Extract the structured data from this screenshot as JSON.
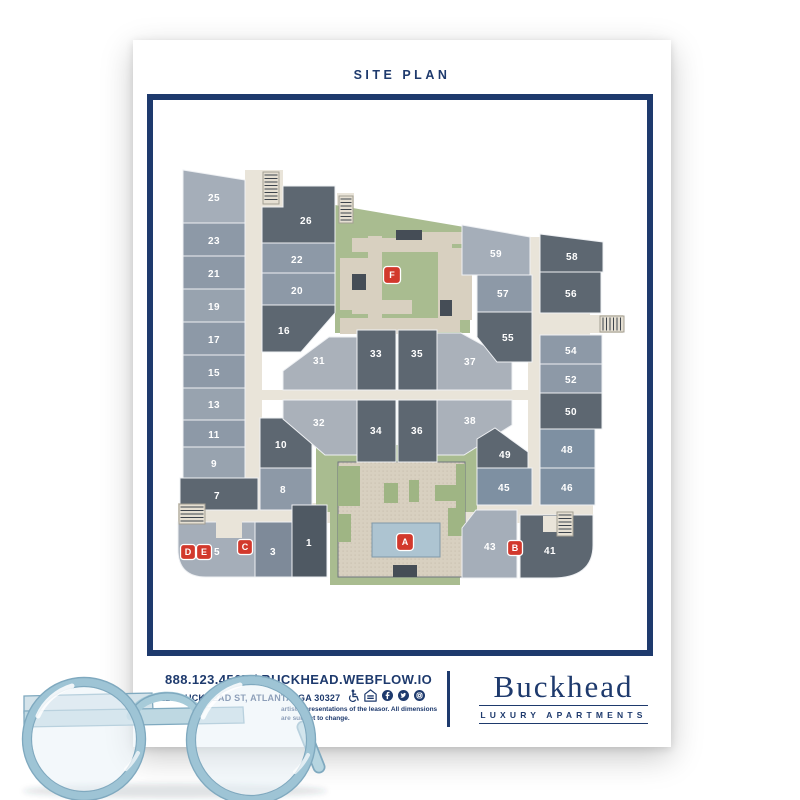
{
  "header": {
    "title": "SITE PLAN"
  },
  "footer": {
    "phone_web": "888.123.4567 / BUCKHEAD.WEBFLOW.IO",
    "address": "123 BUCKHEAD ST, ATLANTA, GA 30327",
    "disclaimer_line1": "artist representations of the leasor. All dimensions",
    "disclaimer_line2": "are subject to change.",
    "logo_name": "Buckhead",
    "logo_tagline": "LUXURY APARTMENTS",
    "icons": [
      "accessibility-icon",
      "equal-housing-icon",
      "facebook-icon",
      "twitter-icon",
      "instagram-icon"
    ]
  },
  "colors": {
    "navy": "#1e3a6d",
    "red": "#d2382c",
    "dark": "#5d6771",
    "dark1": "#4f5963",
    "med": "#8d99a7",
    "med2": "#7e8a99",
    "medblue": "#7e90a2",
    "light": "#a5aeb9",
    "light2": "#98a3af",
    "light3": "#aab1ba",
    "green": "#a9bc90",
    "green2": "#9fb584",
    "tan": "#d8d0c0",
    "road": "#e9e4d9",
    "pool": "#adc4d1",
    "poolStroke": "#7f99a9",
    "darkSq": "#454d56",
    "gap": "#eef0f3",
    "stair": "#e5dfd2",
    "stairStroke": "#a49f93",
    "rung": "#3d444c",
    "plazaStroke": "#6e767e"
  },
  "map": {
    "roads": [
      [
        245,
        170,
        17,
        358
      ],
      [
        245,
        390,
        293,
        10
      ],
      [
        528,
        237,
        12,
        286
      ],
      [
        178,
        503,
        415,
        20
      ],
      [
        262,
        170,
        21,
        37
      ],
      [
        337,
        193,
        17,
        30
      ],
      [
        538,
        313,
        52,
        22
      ],
      [
        590,
        315,
        33,
        18
      ],
      [
        540,
        505,
        40,
        30
      ]
    ],
    "greens": [
      [
        [
          335,
          205
        ],
        [
          470,
          228
        ],
        [
          470,
          333
        ],
        [
          335,
          333
        ]
      ],
      [
        [
          316,
          445
        ],
        [
          477,
          445
        ],
        [
          477,
          512
        ],
        [
          460,
          512
        ],
        [
          460,
          585
        ],
        [
          330,
          585
        ],
        [
          330,
          512
        ],
        [
          316,
          512
        ]
      ]
    ],
    "plaza": [
      [
        338,
        462
      ],
      [
        465,
        462
      ],
      [
        465,
        577
      ],
      [
        338,
        577
      ]
    ],
    "court_tan": [
      [
        352,
        238,
        92,
        14
      ],
      [
        368,
        236,
        14,
        96
      ],
      [
        340,
        258,
        38,
        52
      ],
      [
        340,
        318,
        84,
        16
      ],
      [
        438,
        238,
        14,
        92
      ],
      [
        414,
        232,
        58,
        12
      ],
      [
        452,
        248,
        20,
        72
      ],
      [
        404,
        318,
        56,
        14
      ],
      [
        352,
        300,
        60,
        14
      ]
    ],
    "court_dark": [
      [
        352,
        274,
        14,
        16
      ],
      [
        396,
        230,
        26,
        10
      ],
      [
        440,
        300,
        12,
        16
      ]
    ],
    "patches": [
      [
        338,
        466,
        22,
        40
      ],
      [
        384,
        483,
        14,
        20
      ],
      [
        409,
        480,
        10,
        22
      ],
      [
        435,
        485,
        26,
        16
      ],
      [
        338,
        514,
        13,
        28
      ],
      [
        448,
        508,
        17,
        28
      ],
      [
        456,
        464,
        9,
        44
      ]
    ],
    "pool": [
      372,
      523,
      68,
      34
    ],
    "pool_step": [
      393,
      565,
      24,
      12
    ],
    "units": [
      {
        "n": "25",
        "f": "light",
        "p": [
          [
            183,
            170
          ],
          [
            245,
            180
          ],
          [
            245,
            223
          ],
          [
            183,
            223
          ]
        ],
        "lx": 214,
        "ly": 201
      },
      {
        "n": "23",
        "f": "med",
        "p": [
          [
            183,
            223
          ],
          [
            245,
            223
          ],
          [
            245,
            256
          ],
          [
            183,
            256
          ]
        ],
        "lx": 214,
        "ly": 244
      },
      {
        "n": "21",
        "f": "med",
        "p": [
          [
            183,
            256
          ],
          [
            245,
            256
          ],
          [
            245,
            289
          ],
          [
            183,
            289
          ]
        ],
        "lx": 214,
        "ly": 277
      },
      {
        "n": "19",
        "f": "light2",
        "p": [
          [
            183,
            289
          ],
          [
            245,
            289
          ],
          [
            245,
            322
          ],
          [
            183,
            322
          ]
        ],
        "lx": 214,
        "ly": 310
      },
      {
        "n": "17",
        "f": "med",
        "p": [
          [
            183,
            322
          ],
          [
            245,
            322
          ],
          [
            245,
            355
          ],
          [
            183,
            355
          ]
        ],
        "lx": 214,
        "ly": 343
      },
      {
        "n": "15",
        "f": "med",
        "p": [
          [
            183,
            355
          ],
          [
            245,
            355
          ],
          [
            245,
            388
          ],
          [
            183,
            388
          ]
        ],
        "lx": 214,
        "ly": 376
      },
      {
        "n": "13",
        "f": "light2",
        "p": [
          [
            183,
            388
          ],
          [
            245,
            388
          ],
          [
            245,
            420
          ],
          [
            183,
            420
          ]
        ],
        "lx": 214,
        "ly": 408
      },
      {
        "n": "11",
        "f": "med",
        "p": [
          [
            183,
            420
          ],
          [
            245,
            420
          ],
          [
            245,
            447
          ],
          [
            183,
            447
          ]
        ],
        "lx": 214,
        "ly": 438
      },
      {
        "n": "9",
        "f": "light2",
        "p": [
          [
            183,
            447
          ],
          [
            245,
            447
          ],
          [
            245,
            478
          ],
          [
            183,
            478
          ]
        ],
        "lx": 214,
        "ly": 467
      },
      {
        "n": "7",
        "f": "dark",
        "p": [
          [
            180,
            478
          ],
          [
            258,
            478
          ],
          [
            258,
            510
          ],
          [
            180,
            510
          ]
        ],
        "lx": 217,
        "ly": 499
      },
      {
        "n": "26",
        "f": "dark",
        "p": [
          [
            283,
            186
          ],
          [
            335,
            186
          ],
          [
            335,
            243
          ],
          [
            262,
            243
          ],
          [
            262,
            207
          ],
          [
            283,
            207
          ]
        ],
        "lx": 306,
        "ly": 224
      },
      {
        "n": "22",
        "f": "med",
        "p": [
          [
            262,
            243
          ],
          [
            335,
            243
          ],
          [
            335,
            273
          ],
          [
            262,
            273
          ]
        ],
        "lx": 297,
        "ly": 263
      },
      {
        "n": "20",
        "f": "med",
        "p": [
          [
            262,
            273
          ],
          [
            335,
            273
          ],
          [
            335,
            305
          ],
          [
            262,
            305
          ]
        ],
        "lx": 297,
        "ly": 294
      },
      {
        "n": "16",
        "f": "dark",
        "p": [
          [
            262,
            305
          ],
          [
            335,
            305
          ],
          [
            335,
            313
          ],
          [
            301,
            352
          ],
          [
            262,
            352
          ]
        ],
        "lx": 284,
        "ly": 334
      },
      {
        "n": "10",
        "f": "dark",
        "p": [
          [
            260,
            418
          ],
          [
            287,
            418
          ],
          [
            312,
            444
          ],
          [
            312,
            468
          ],
          [
            260,
            468
          ]
        ],
        "lx": 281,
        "ly": 448
      },
      {
        "n": "8",
        "f": "med",
        "p": [
          [
            260,
            468
          ],
          [
            312,
            468
          ],
          [
            312,
            510
          ],
          [
            260,
            510
          ]
        ],
        "lx": 283,
        "ly": 493
      },
      {
        "n": "1",
        "f": "dark1",
        "p": [
          [
            292,
            505
          ],
          [
            327,
            505
          ],
          [
            327,
            577
          ],
          [
            292,
            577
          ]
        ],
        "lx": 309,
        "ly": 546
      },
      {
        "n": "3",
        "f": "med2",
        "p": [
          [
            255,
            522
          ],
          [
            292,
            522
          ],
          [
            292,
            577
          ],
          [
            255,
            577
          ]
        ],
        "lx": 273,
        "ly": 555
      },
      {
        "n": "5",
        "f": "light",
        "path": "M178,522 L255,522 L255,577 L206,577 Q178,577 178,549 Z",
        "lx": 217,
        "ly": 555
      },
      {
        "n": "31",
        "f": "light3",
        "p": [
          [
            357,
            337
          ],
          [
            357,
            390
          ],
          [
            283,
            390
          ],
          [
            283,
            371
          ],
          [
            329,
            337
          ]
        ],
        "lx": 319,
        "ly": 364
      },
      {
        "n": "33",
        "f": "dark",
        "p": [
          [
            357,
            330
          ],
          [
            396,
            330
          ],
          [
            396,
            390
          ],
          [
            357,
            390
          ]
        ],
        "lx": 376,
        "ly": 357
      },
      {
        "n": "35",
        "f": "dark",
        "p": [
          [
            398,
            330
          ],
          [
            437,
            330
          ],
          [
            437,
            390
          ],
          [
            398,
            390
          ]
        ],
        "lx": 417,
        "ly": 357
      },
      {
        "n": "37",
        "f": "light3",
        "p": [
          [
            437,
            333
          ],
          [
            461,
            333
          ],
          [
            512,
            361
          ],
          [
            512,
            390
          ],
          [
            437,
            390
          ]
        ],
        "lx": 470,
        "ly": 365
      },
      {
        "n": "55",
        "f": "dark",
        "p": [
          [
            477,
            312
          ],
          [
            532,
            312
          ],
          [
            532,
            362
          ],
          [
            497,
            362
          ],
          [
            477,
            337
          ]
        ],
        "lx": 508,
        "ly": 341
      },
      {
        "n": "57",
        "f": "med",
        "p": [
          [
            477,
            275
          ],
          [
            532,
            275
          ],
          [
            532,
            312
          ],
          [
            477,
            312
          ]
        ],
        "lx": 503,
        "ly": 297
      },
      {
        "n": "59",
        "f": "light",
        "p": [
          [
            462,
            225
          ],
          [
            530,
            237
          ],
          [
            530,
            275
          ],
          [
            462,
            275
          ]
        ],
        "lx": 496,
        "ly": 257
      },
      {
        "n": "32",
        "f": "light3",
        "p": [
          [
            283,
            400
          ],
          [
            357,
            400
          ],
          [
            357,
            455
          ],
          [
            325,
            455
          ],
          [
            283,
            419
          ]
        ],
        "lx": 319,
        "ly": 426
      },
      {
        "n": "34",
        "f": "dark",
        "p": [
          [
            357,
            400
          ],
          [
            396,
            400
          ],
          [
            396,
            462
          ],
          [
            357,
            462
          ]
        ],
        "lx": 376,
        "ly": 434
      },
      {
        "n": "36",
        "f": "dark",
        "p": [
          [
            398,
            400
          ],
          [
            437,
            400
          ],
          [
            437,
            462
          ],
          [
            398,
            462
          ]
        ],
        "lx": 417,
        "ly": 434
      },
      {
        "n": "38",
        "f": "light3",
        "p": [
          [
            437,
            400
          ],
          [
            512,
            400
          ],
          [
            512,
            425
          ],
          [
            464,
            455
          ],
          [
            437,
            455
          ]
        ],
        "lx": 470,
        "ly": 424
      },
      {
        "n": "49",
        "f": "dark",
        "p": [
          [
            477,
            439
          ],
          [
            495,
            428
          ],
          [
            528,
            452
          ],
          [
            528,
            468
          ],
          [
            477,
            468
          ]
        ],
        "lx": 505,
        "ly": 458
      },
      {
        "n": "45",
        "f": "medblue",
        "p": [
          [
            477,
            468
          ],
          [
            532,
            468
          ],
          [
            532,
            505
          ],
          [
            477,
            505
          ]
        ],
        "lx": 504,
        "ly": 491
      },
      {
        "n": "43",
        "f": "light",
        "p": [
          [
            462,
            528
          ],
          [
            476,
            510
          ],
          [
            517,
            510
          ],
          [
            517,
            578
          ],
          [
            462,
            578
          ]
        ],
        "lx": 490,
        "ly": 550
      },
      {
        "n": "41",
        "f": "dark",
        "path": "M520,515 L593,515 L593,545 Q593,578 552,578 L520,578 Z",
        "lx": 550,
        "ly": 554
      },
      {
        "n": "58",
        "f": "dark",
        "p": [
          [
            540,
            234
          ],
          [
            603,
            242
          ],
          [
            603,
            272
          ],
          [
            540,
            272
          ]
        ],
        "lx": 572,
        "ly": 260
      },
      {
        "n": "56",
        "f": "dark",
        "p": [
          [
            540,
            272
          ],
          [
            601,
            272
          ],
          [
            601,
            313
          ],
          [
            540,
            313
          ]
        ],
        "lx": 571,
        "ly": 297
      },
      {
        "n": "54",
        "f": "med",
        "p": [
          [
            540,
            335
          ],
          [
            602,
            335
          ],
          [
            602,
            364
          ],
          [
            540,
            364
          ]
        ],
        "lx": 571,
        "ly": 354
      },
      {
        "n": "52",
        "f": "med",
        "p": [
          [
            540,
            364
          ],
          [
            602,
            364
          ],
          [
            602,
            393
          ],
          [
            540,
            393
          ]
        ],
        "lx": 571,
        "ly": 383
      },
      {
        "n": "50",
        "f": "dark",
        "p": [
          [
            540,
            393
          ],
          [
            602,
            393
          ],
          [
            602,
            429
          ],
          [
            540,
            429
          ]
        ],
        "lx": 571,
        "ly": 415
      },
      {
        "n": "48",
        "f": "medblue",
        "p": [
          [
            540,
            429
          ],
          [
            595,
            429
          ],
          [
            595,
            468
          ],
          [
            540,
            468
          ]
        ],
        "lx": 567,
        "ly": 453
      },
      {
        "n": "46",
        "f": "medblue",
        "p": [
          [
            540,
            468
          ],
          [
            595,
            468
          ],
          [
            595,
            505
          ],
          [
            540,
            505
          ]
        ],
        "lx": 567,
        "ly": 491
      }
    ],
    "notches": [
      [
        216,
        521,
        26,
        17
      ],
      [
        543,
        516,
        14,
        16
      ]
    ],
    "stairs": [
      {
        "b": [
          263,
          172,
          16,
          32
        ],
        "d": "v"
      },
      {
        "b": [
          339,
          196,
          14,
          27
        ],
        "d": "v"
      },
      {
        "b": [
          600,
          316,
          24,
          16
        ],
        "d": "h"
      },
      {
        "b": [
          179,
          504,
          26,
          20
        ],
        "d": "v"
      },
      {
        "b": [
          557,
          512,
          16,
          24
        ],
        "d": "v"
      }
    ],
    "markers": [
      {
        "l": "A",
        "x": 405,
        "y": 542
      },
      {
        "l": "B",
        "x": 515,
        "y": 548
      },
      {
        "l": "C",
        "x": 245,
        "y": 547
      },
      {
        "l": "D",
        "x": 188,
        "y": 552
      },
      {
        "l": "E",
        "x": 204,
        "y": 552
      },
      {
        "l": "F",
        "x": 392,
        "y": 275
      }
    ]
  }
}
